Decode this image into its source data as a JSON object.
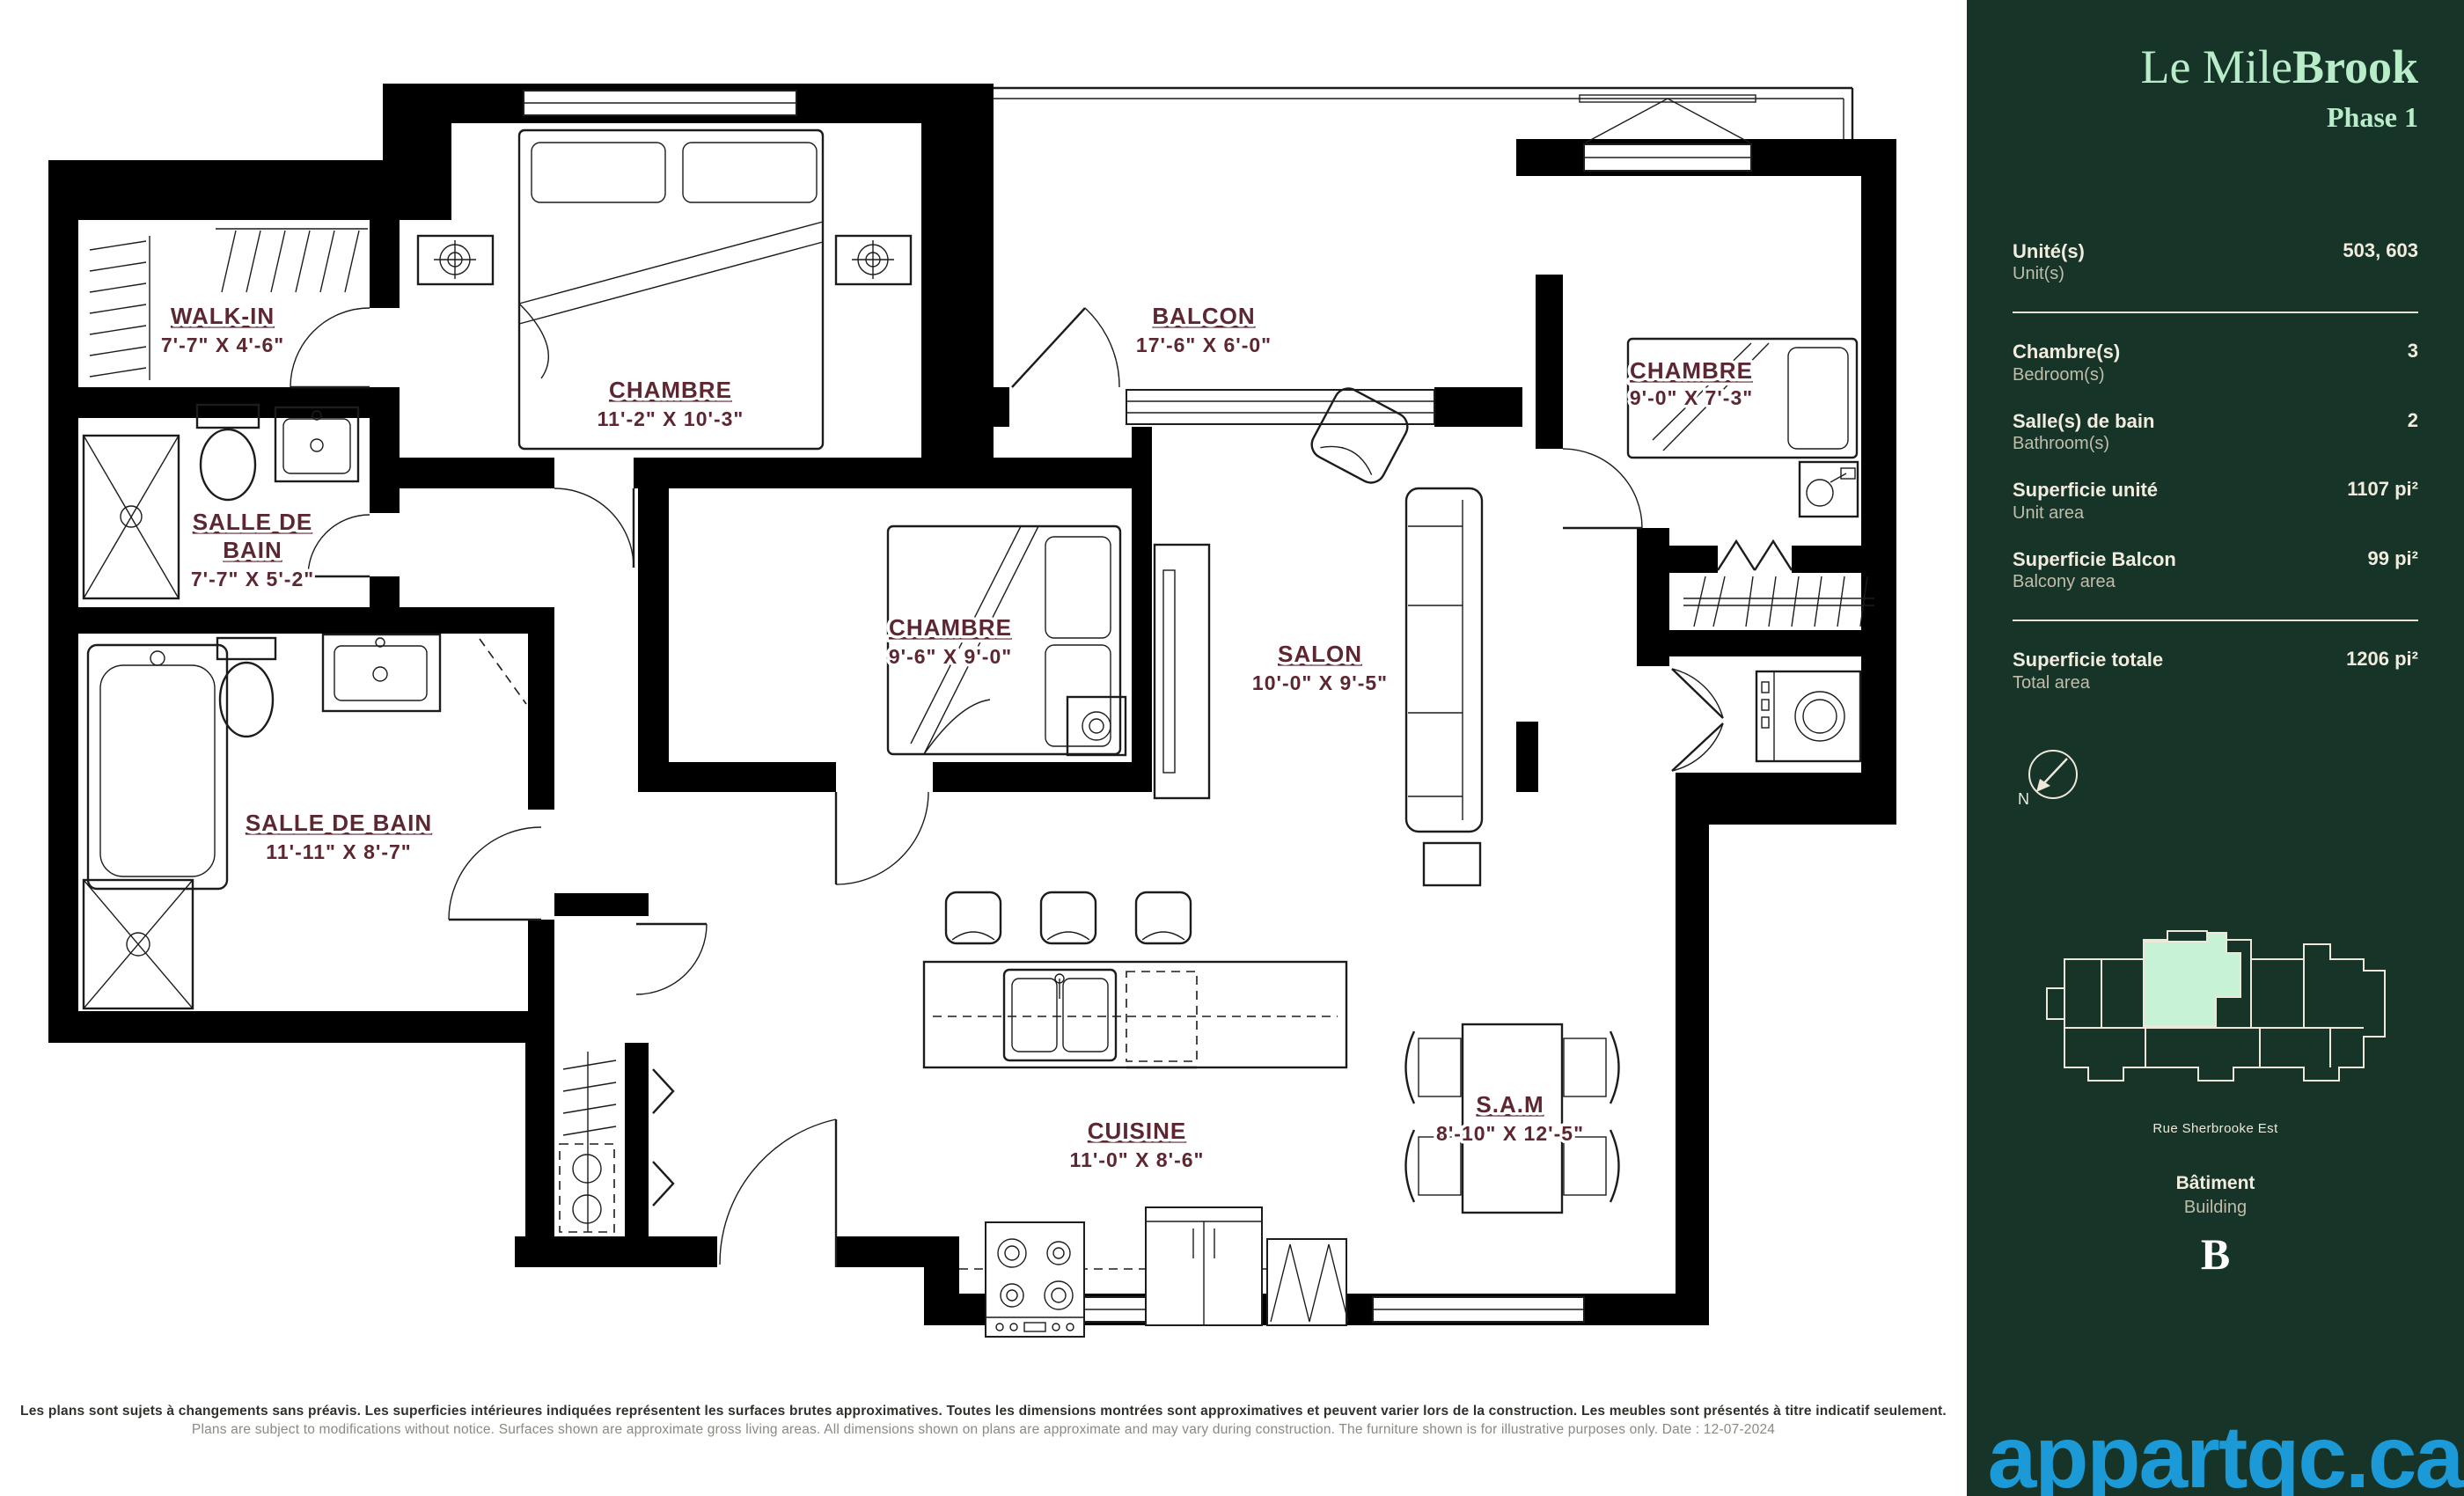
{
  "sidebar": {
    "brand": {
      "title_regular": "Le Mile",
      "title_bold": "Brook",
      "phase": "Phase 1"
    },
    "specs": [
      {
        "label_fr": "Unité(s)",
        "label_en": "Unit(s)",
        "value": "503, 603"
      },
      {
        "label_fr": "Chambre(s)",
        "label_en": "Bedroom(s)",
        "value": "3"
      },
      {
        "label_fr": "Salle(s) de bain",
        "label_en": "Bathroom(s)",
        "value": "2"
      },
      {
        "label_fr": "Superficie unité",
        "label_en": "Unit area",
        "value": "1107 pi²"
      },
      {
        "label_fr": "Superficie Balcon",
        "label_en": "Balcony area",
        "value": "99 pi²"
      },
      {
        "label_fr": "Superficie totale",
        "label_en": "Total area",
        "value": "1206 pi²"
      }
    ],
    "compass_label": "N",
    "map_caption": "Rue Sherbrooke Est",
    "building": {
      "label_fr": "Bâtiment",
      "label_en": "Building",
      "value": "B"
    },
    "watermark": "appartqc.ca",
    "colors": {
      "background": "#163528",
      "title": "#b9edca",
      "text": "#f2ecdf",
      "highlight": "#c8f2d6",
      "watermark": "#1c9ad8"
    }
  },
  "plan": {
    "rooms": {
      "walkin": {
        "name": "WALK-IN",
        "dims": "7'-7\" X 4'-6\""
      },
      "bath1": {
        "name_line1": "SALLE DE",
        "name_line2": "BAIN",
        "dims": "7'-7\" X 5'-2\""
      },
      "chambre1": {
        "name": "CHAMBRE",
        "dims": "11'-2\" X 10'-3\""
      },
      "balcon": {
        "name": "BALCON",
        "dims": "17'-6\" X 6'-0\""
      },
      "chambre2": {
        "name": "CHAMBRE",
        "dims": "9'-6\" X 9'-0\""
      },
      "salon": {
        "name": "SALON",
        "dims": "10'-0\" X 9'-5\""
      },
      "chambre3": {
        "name": "CHAMBRE",
        "dims": "9'-0\" X 7'-3\""
      },
      "bath2": {
        "name": "SALLE DE BAIN",
        "dims": "11'-11\" X 8'-7\""
      },
      "cuisine": {
        "name": "CUISINE",
        "dims": "11'-0\" X 8'-6\""
      },
      "sam": {
        "name": "S.A.M",
        "dims": "8'-10\" X 12'-5\""
      }
    },
    "label_color": "#5c2730",
    "disclaimer_fr": "Les plans sont sujets à changements sans préavis. Les superficies intérieures indiquées représentent les surfaces brutes approximatives. Toutes les dimensions montrées sont approximatives et peuvent varier lors de la construction. Les meubles sont présentés à titre indicatif seulement.",
    "disclaimer_en": "Plans are subject to modifications without notice. Surfaces shown are approximate gross living areas. All dimensions shown on plans are approximate and may vary during construction. The furniture shown is for illustrative purposes only. Date : 12-07-2024"
  }
}
